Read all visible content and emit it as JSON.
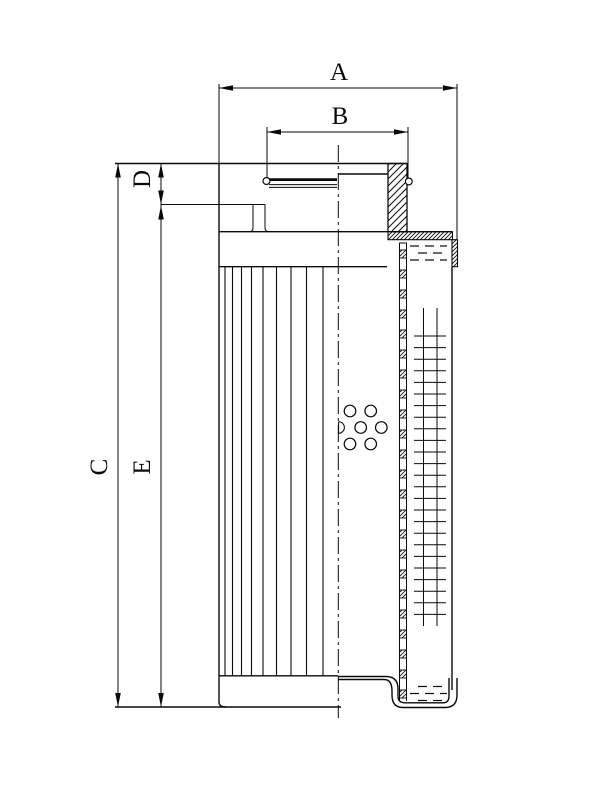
{
  "drawing": {
    "labels": {
      "a": "A",
      "b": "B",
      "c": "C",
      "d": "D",
      "e": "E"
    },
    "colors": {
      "ink": "#0a0a0a",
      "paper": "#ffffff"
    }
  }
}
